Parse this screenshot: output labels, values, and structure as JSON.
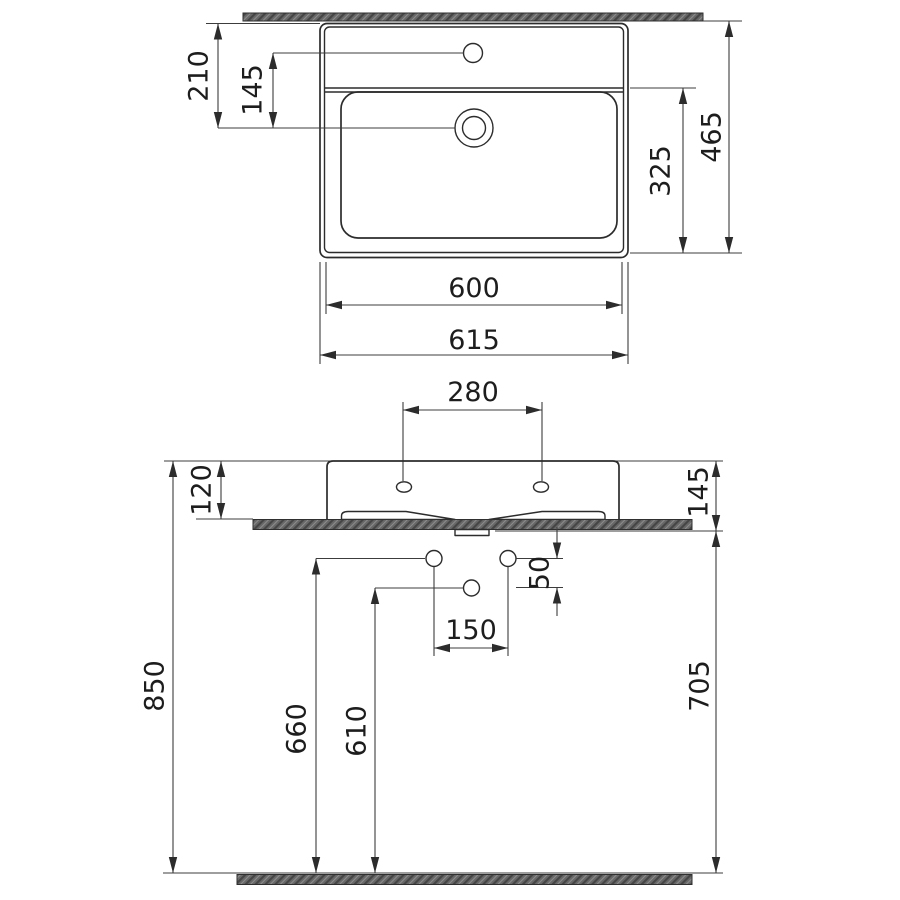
{
  "drawing_type": "washbasin installation dimension drawing",
  "unit": "mm",
  "colors": {
    "line": "#2c2c2c",
    "text": "#1d1d1d",
    "hatch_fill": "#686868",
    "background": "#ffffff"
  },
  "plan_view": {
    "dims": {
      "rear_to_drain": "210",
      "faucet_to_drain": "145",
      "total_depth": "465",
      "bowl_depth": "325",
      "body_width": "600",
      "total_width": "615"
    }
  },
  "front_view": {
    "dims": {
      "faucet_holes_spacing": "280",
      "apron_height": "120",
      "front_edge_height": "145",
      "supply_to_drain_offset": "50",
      "supply_spacing": "150",
      "rim_height_from_floor": "850",
      "supply_height_from_floor": "660",
      "drain_height_from_floor": "610",
      "clearance_under_basin": "705"
    }
  }
}
